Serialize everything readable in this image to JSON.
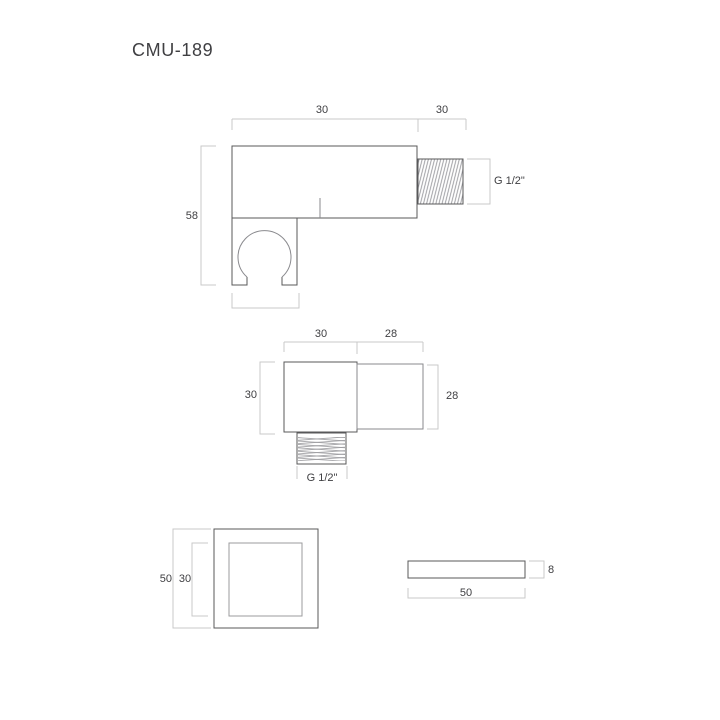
{
  "title": "CMU-189",
  "colors": {
    "part_line": "#58585a",
    "part_line_medium": "#8a8a8e",
    "part_line_light": "#9b9b9e",
    "dim_line": "#c9c9c9",
    "hatch": "#95959a",
    "text": "#3f3f42"
  },
  "views": {
    "side": {
      "dims": {
        "body_width": "30",
        "thread_length": "30",
        "total_height": "58",
        "thread_size": "G 1/2\""
      }
    },
    "bottom": {
      "dims": {
        "body_width": "30",
        "spout_length": "28",
        "body_depth": "30",
        "spout_width": "28",
        "thread_size": "G 1/2\""
      }
    },
    "flange_front": {
      "dims": {
        "outer_size": "50",
        "inner_size": "30"
      }
    },
    "flange_side": {
      "dims": {
        "thickness": "8",
        "width": "50"
      }
    }
  }
}
